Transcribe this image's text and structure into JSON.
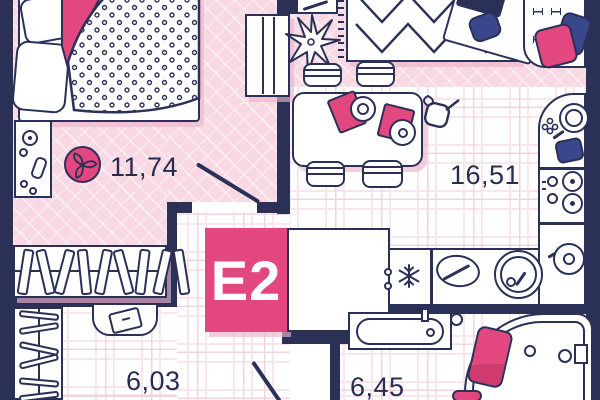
{
  "floorplan": {
    "unit": {
      "label": "E2"
    },
    "rooms": [
      {
        "id": "bedroom",
        "area": "11,74"
      },
      {
        "id": "kitchen-living",
        "area": "16,51"
      },
      {
        "id": "hallway",
        "area": "6,03"
      },
      {
        "id": "bathroom",
        "area": "6,45"
      }
    ],
    "icons": [
      "bed",
      "pillow",
      "blanket",
      "nightstand",
      "lamp",
      "pouf",
      "wardrobe-sliding",
      "clothes-rack",
      "hanger",
      "door-swing",
      "plant",
      "rug-chevron",
      "throw-with-laptop",
      "sofa",
      "cushion",
      "dining-table",
      "plate",
      "napkin",
      "watering-can",
      "stool",
      "fridge-snowflake",
      "cutting-board",
      "knife",
      "round-sink",
      "stove-burners",
      "kettle",
      "teapot",
      "pan",
      "bench",
      "briefcase",
      "bathroom-sink",
      "bathtub",
      "towel",
      "drain",
      "faucet"
    ],
    "colors": {
      "wall": "#2b3057",
      "accent_pink": "#e2487f",
      "accent_blue": "#3a478c",
      "floor_pink": "#f8d9e3",
      "tile_grout": "#f0d4de"
    }
  }
}
